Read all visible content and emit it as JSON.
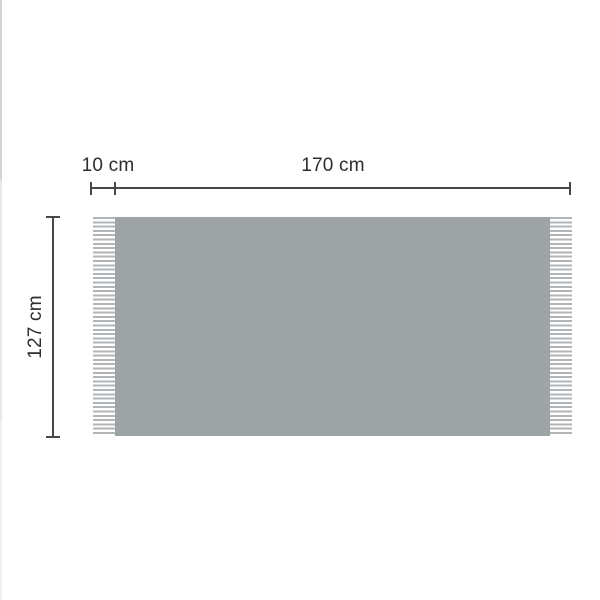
{
  "diagram": {
    "type": "product-dimension-diagram",
    "subject": "blanket-with-fringes",
    "measurements": [
      {
        "id": "fringe-width",
        "label": "10 cm",
        "value_cm": 10,
        "orientation": "horizontal",
        "refers_to": "fringe length"
      },
      {
        "id": "body-width",
        "label": "170 cm",
        "value_cm": 170,
        "orientation": "horizontal",
        "refers_to": "blanket width"
      },
      {
        "id": "height",
        "label": "127 cm",
        "value_cm": 127,
        "orientation": "vertical",
        "refers_to": "blanket height"
      }
    ],
    "colors": {
      "body": "#9ea3a6",
      "fringe_stripe": "#b2b5b7",
      "line": "#48484a",
      "text": "#2d2d2d",
      "background": "#ffffff"
    }
  }
}
